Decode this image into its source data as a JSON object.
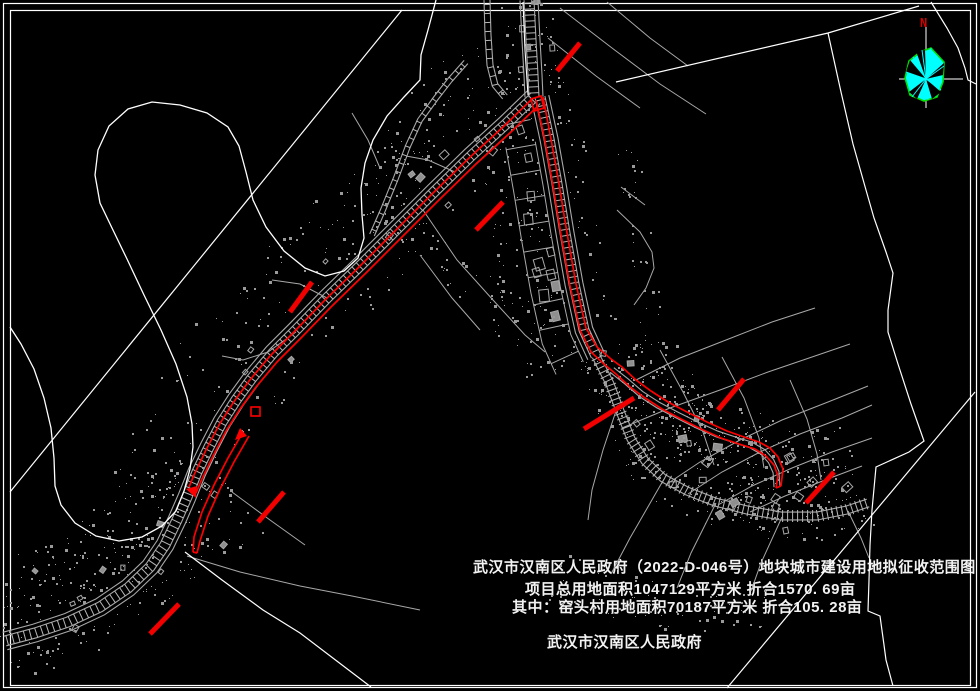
{
  "title_block": {
    "line1": "武汉市汉南区人民政府（2022-D-046号）地块城市建设用地拟征收范围图",
    "line2": "项目总用地面积1047129平方米  折合1570. 69亩",
    "line3": "其中：窑头村用地面积70187平方米  折合105. 28亩",
    "signature": "武汉市汉南区人民政府"
  },
  "north_arrow": {
    "label": "N"
  },
  "colors": {
    "background": "#000000",
    "base_linework": "#ffffff",
    "topo_gray": "#a8a8a8",
    "topo_gray_light": "#b8b8b8",
    "dot_gray": "#9a9a9a",
    "redline": "#ff0000",
    "tick_red": "#f20000",
    "compass_fill": "#00ffff",
    "compass_outline": "#00e000",
    "north_label_red": "#d40000",
    "title_text": "#f2f2f2"
  }
}
